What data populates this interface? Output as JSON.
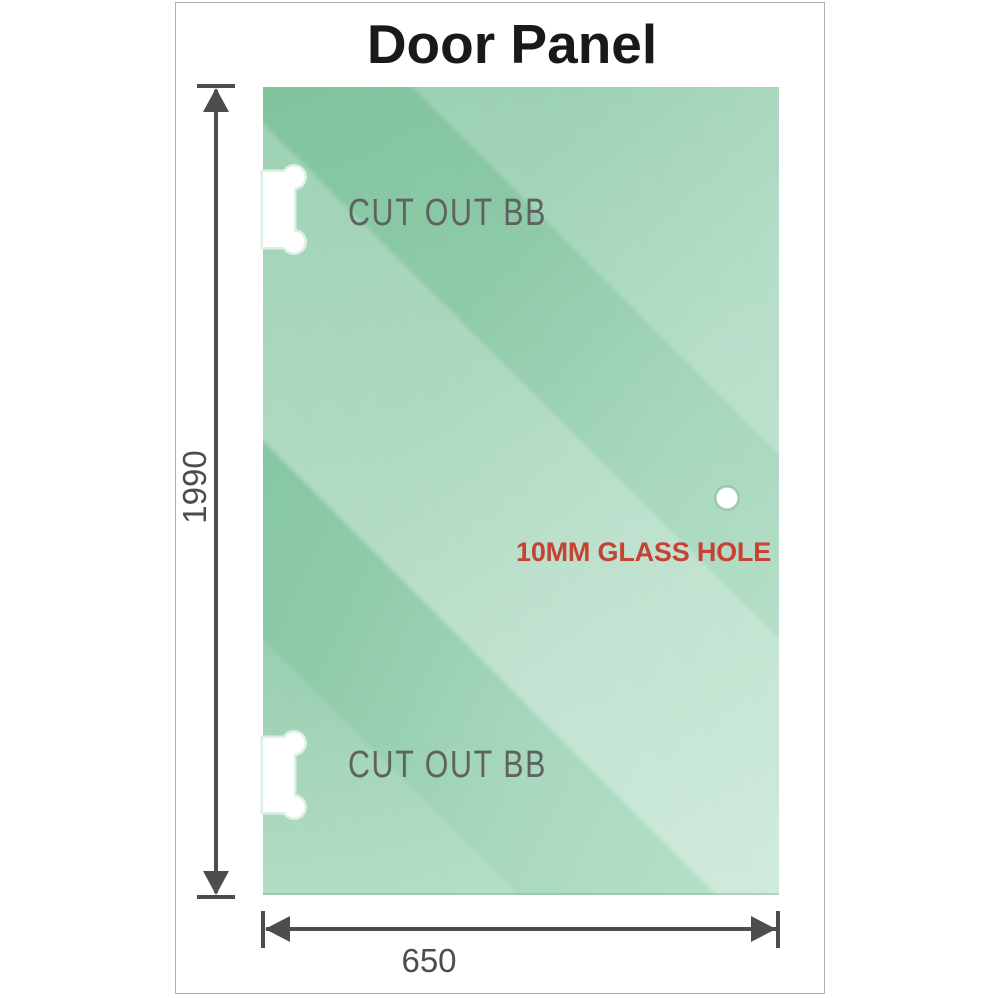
{
  "title": "Door Panel",
  "panel": {
    "cutouts": [
      {
        "label": "CUT OUT BB"
      },
      {
        "label": "CUT OUT BB"
      }
    ],
    "hole": {
      "label": "10MM GLASS HOLE"
    }
  },
  "dimensions": {
    "height": "1990",
    "width": "650"
  },
  "colors": {
    "glass_dark": "#7bc29a",
    "glass_light": "#b9e1ca",
    "dimension_line": "#4d4d4d",
    "cutout_label_gray": "#5e6360",
    "hole_label_red": "#c64232",
    "frame_border": "#b1b1b1"
  }
}
